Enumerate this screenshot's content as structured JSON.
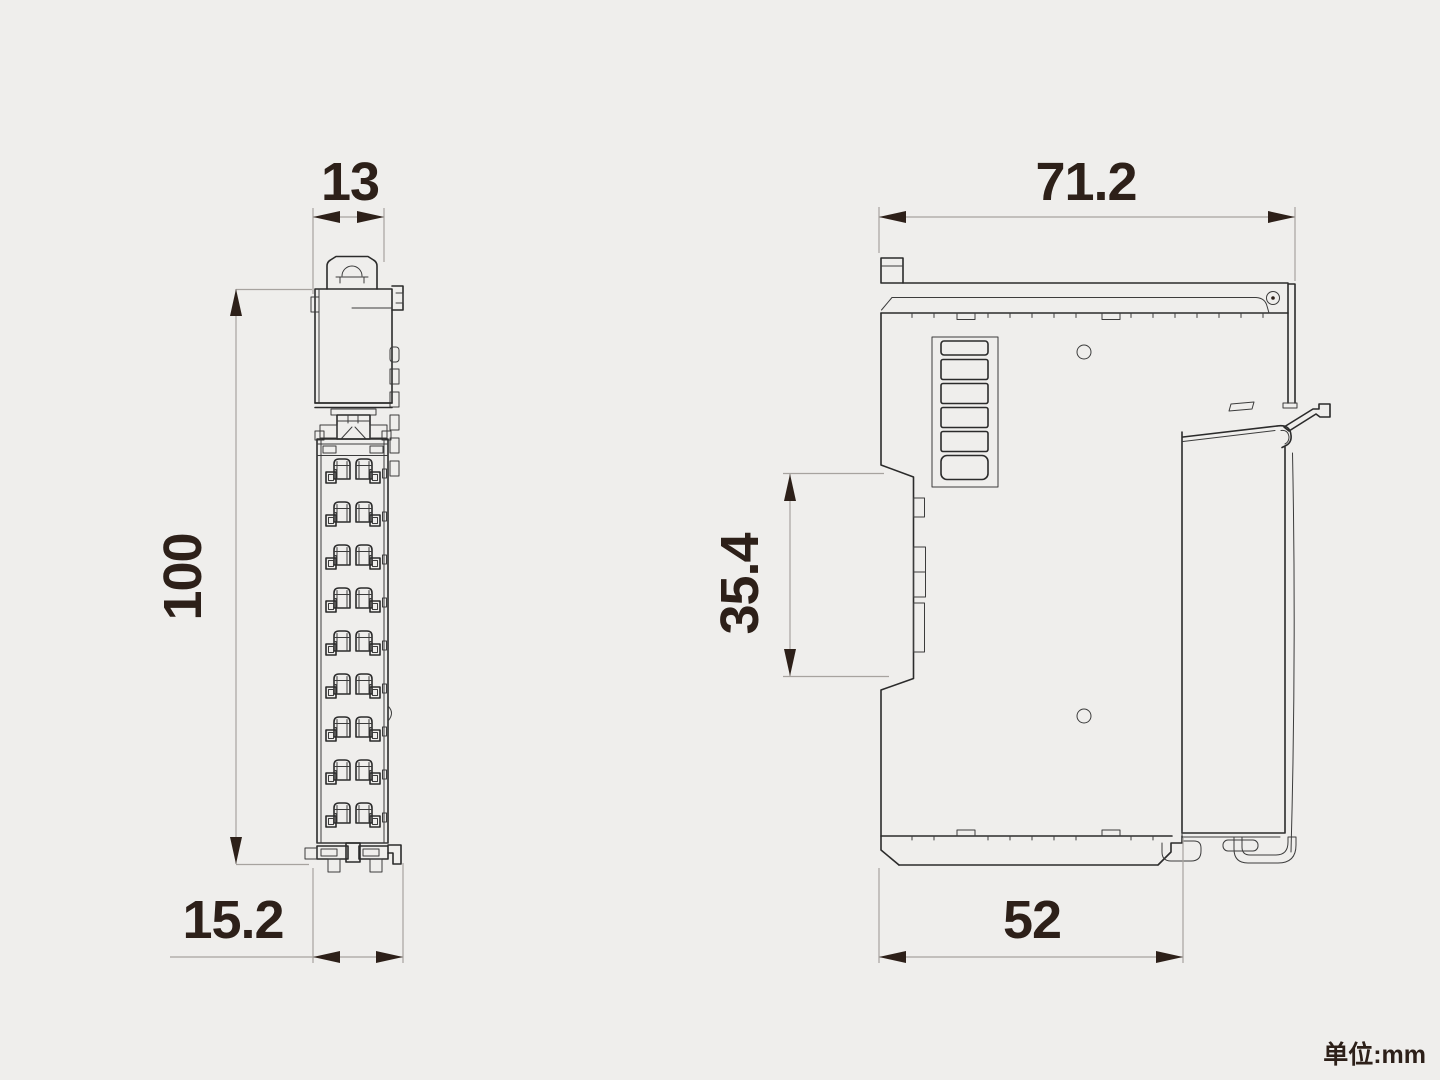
{
  "unit_note": "单位:mm",
  "unit": "mm",
  "colors": {
    "background": "#efeeec",
    "outline": "#2b2b2b",
    "dimension_text": "#2d2019",
    "extension_line": "#a7a39f"
  },
  "views": {
    "front": {
      "name": "front view",
      "dimensions": {
        "width_top": "13",
        "height": "100",
        "width_bottom": "15.2"
      }
    },
    "side": {
      "name": "side view",
      "dimensions": {
        "width_total": "71.2",
        "rail_recess_height": "35.4",
        "depth_body": "52"
      }
    }
  }
}
